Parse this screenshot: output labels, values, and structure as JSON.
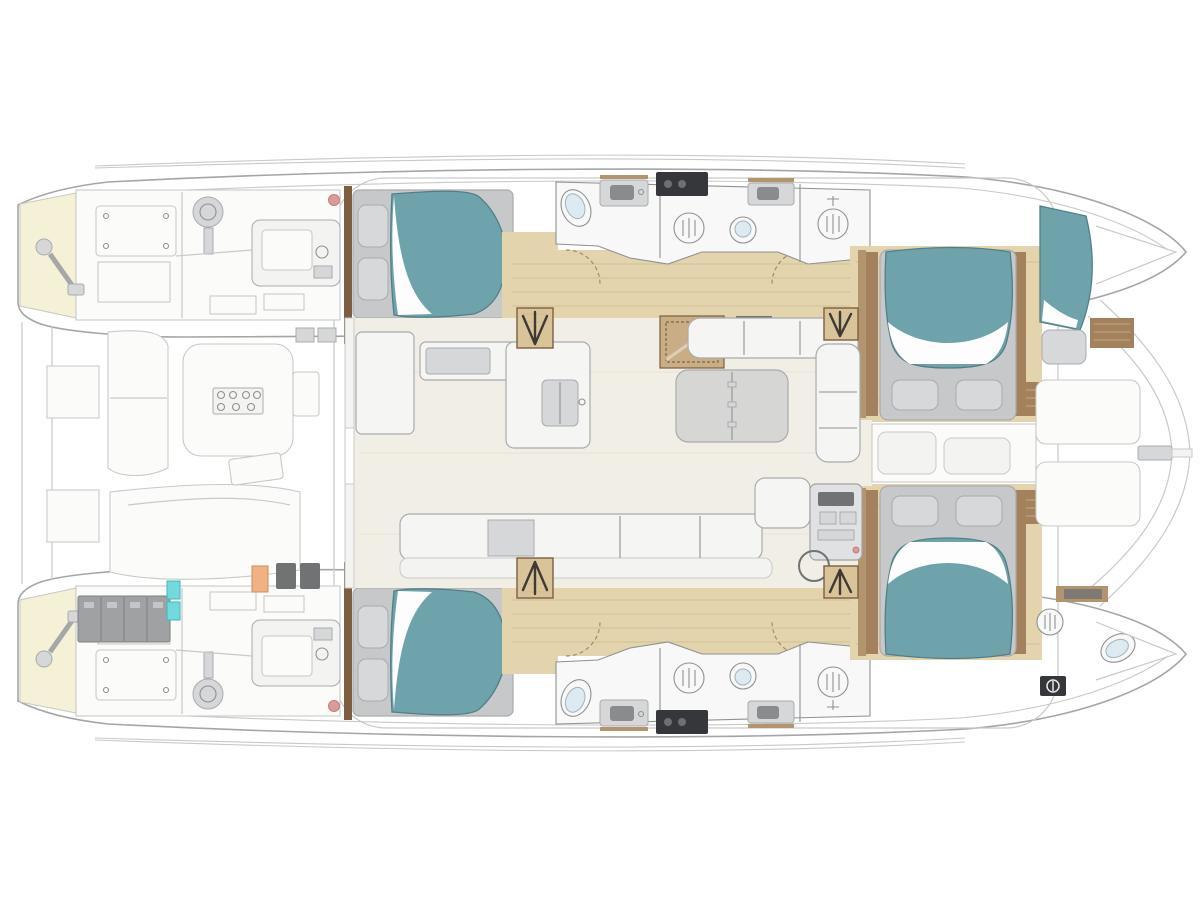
{
  "palette": {
    "hull-outline": "#a4a6a5",
    "ghost": "#c9c9c7",
    "ghost-fill": "#fbfbfa",
    "ghost-soft": "#f3f3f1",
    "white-fixture": "#f7f8f7",
    "fixture-stroke": "#8f9192",
    "oak": "#e3d4ae",
    "oak-dark": "#cdbb8f",
    "oak-step": "#d9c49a",
    "walnut": "#7d5e41",
    "walnut-mid": "#a2815c",
    "walnut-light": "#b2946e",
    "teal": "#6fa3ab",
    "teal-dark": "#527f87",
    "sheet-white": "#fdfdfd",
    "pillow": "#d6d8d9",
    "bed-base": "#c6c8ca",
    "gray-soft": "#d5d7d8",
    "gray-mid": "#a9abac",
    "gray-dark": "#707274",
    "appliance-dark": "#35373a",
    "battery": "#9fa1a2",
    "battery-dark": "#7e8081",
    "cyan": "#74d8dc",
    "cyan-dark": "#3fb9bd",
    "orange": "#f0b184",
    "orange-dark": "#d08d57",
    "red-accent": "#dc9b9b",
    "red-accent-dark": "#c47f7f",
    "cream": "#f1eee6",
    "tan-hatch": "#c9ae85",
    "table-gray": "#d6d6d4",
    "sofa-white": "#f5f5f3",
    "door-arc": "#a98a5f",
    "stair-glyph": "#3f3a33"
  },
  "plan": {
    "type": "catamaran-accommodation-floor-plan",
    "orientation": {
      "bow": "right",
      "stern": "left"
    },
    "inventory": {
      "hulls": 2,
      "double_berths": 4,
      "forepeak_berths": 1,
      "crew_head_bow": 1,
      "toilets": 5,
      "showers": 5,
      "washbasins": 4,
      "galley_sinks": 1,
      "dining_tables": 1,
      "cockpit_tables": 1,
      "helm_stations": 1,
      "companionway_stairs": 4,
      "engines": 2,
      "battery_banks": 1
    }
  }
}
